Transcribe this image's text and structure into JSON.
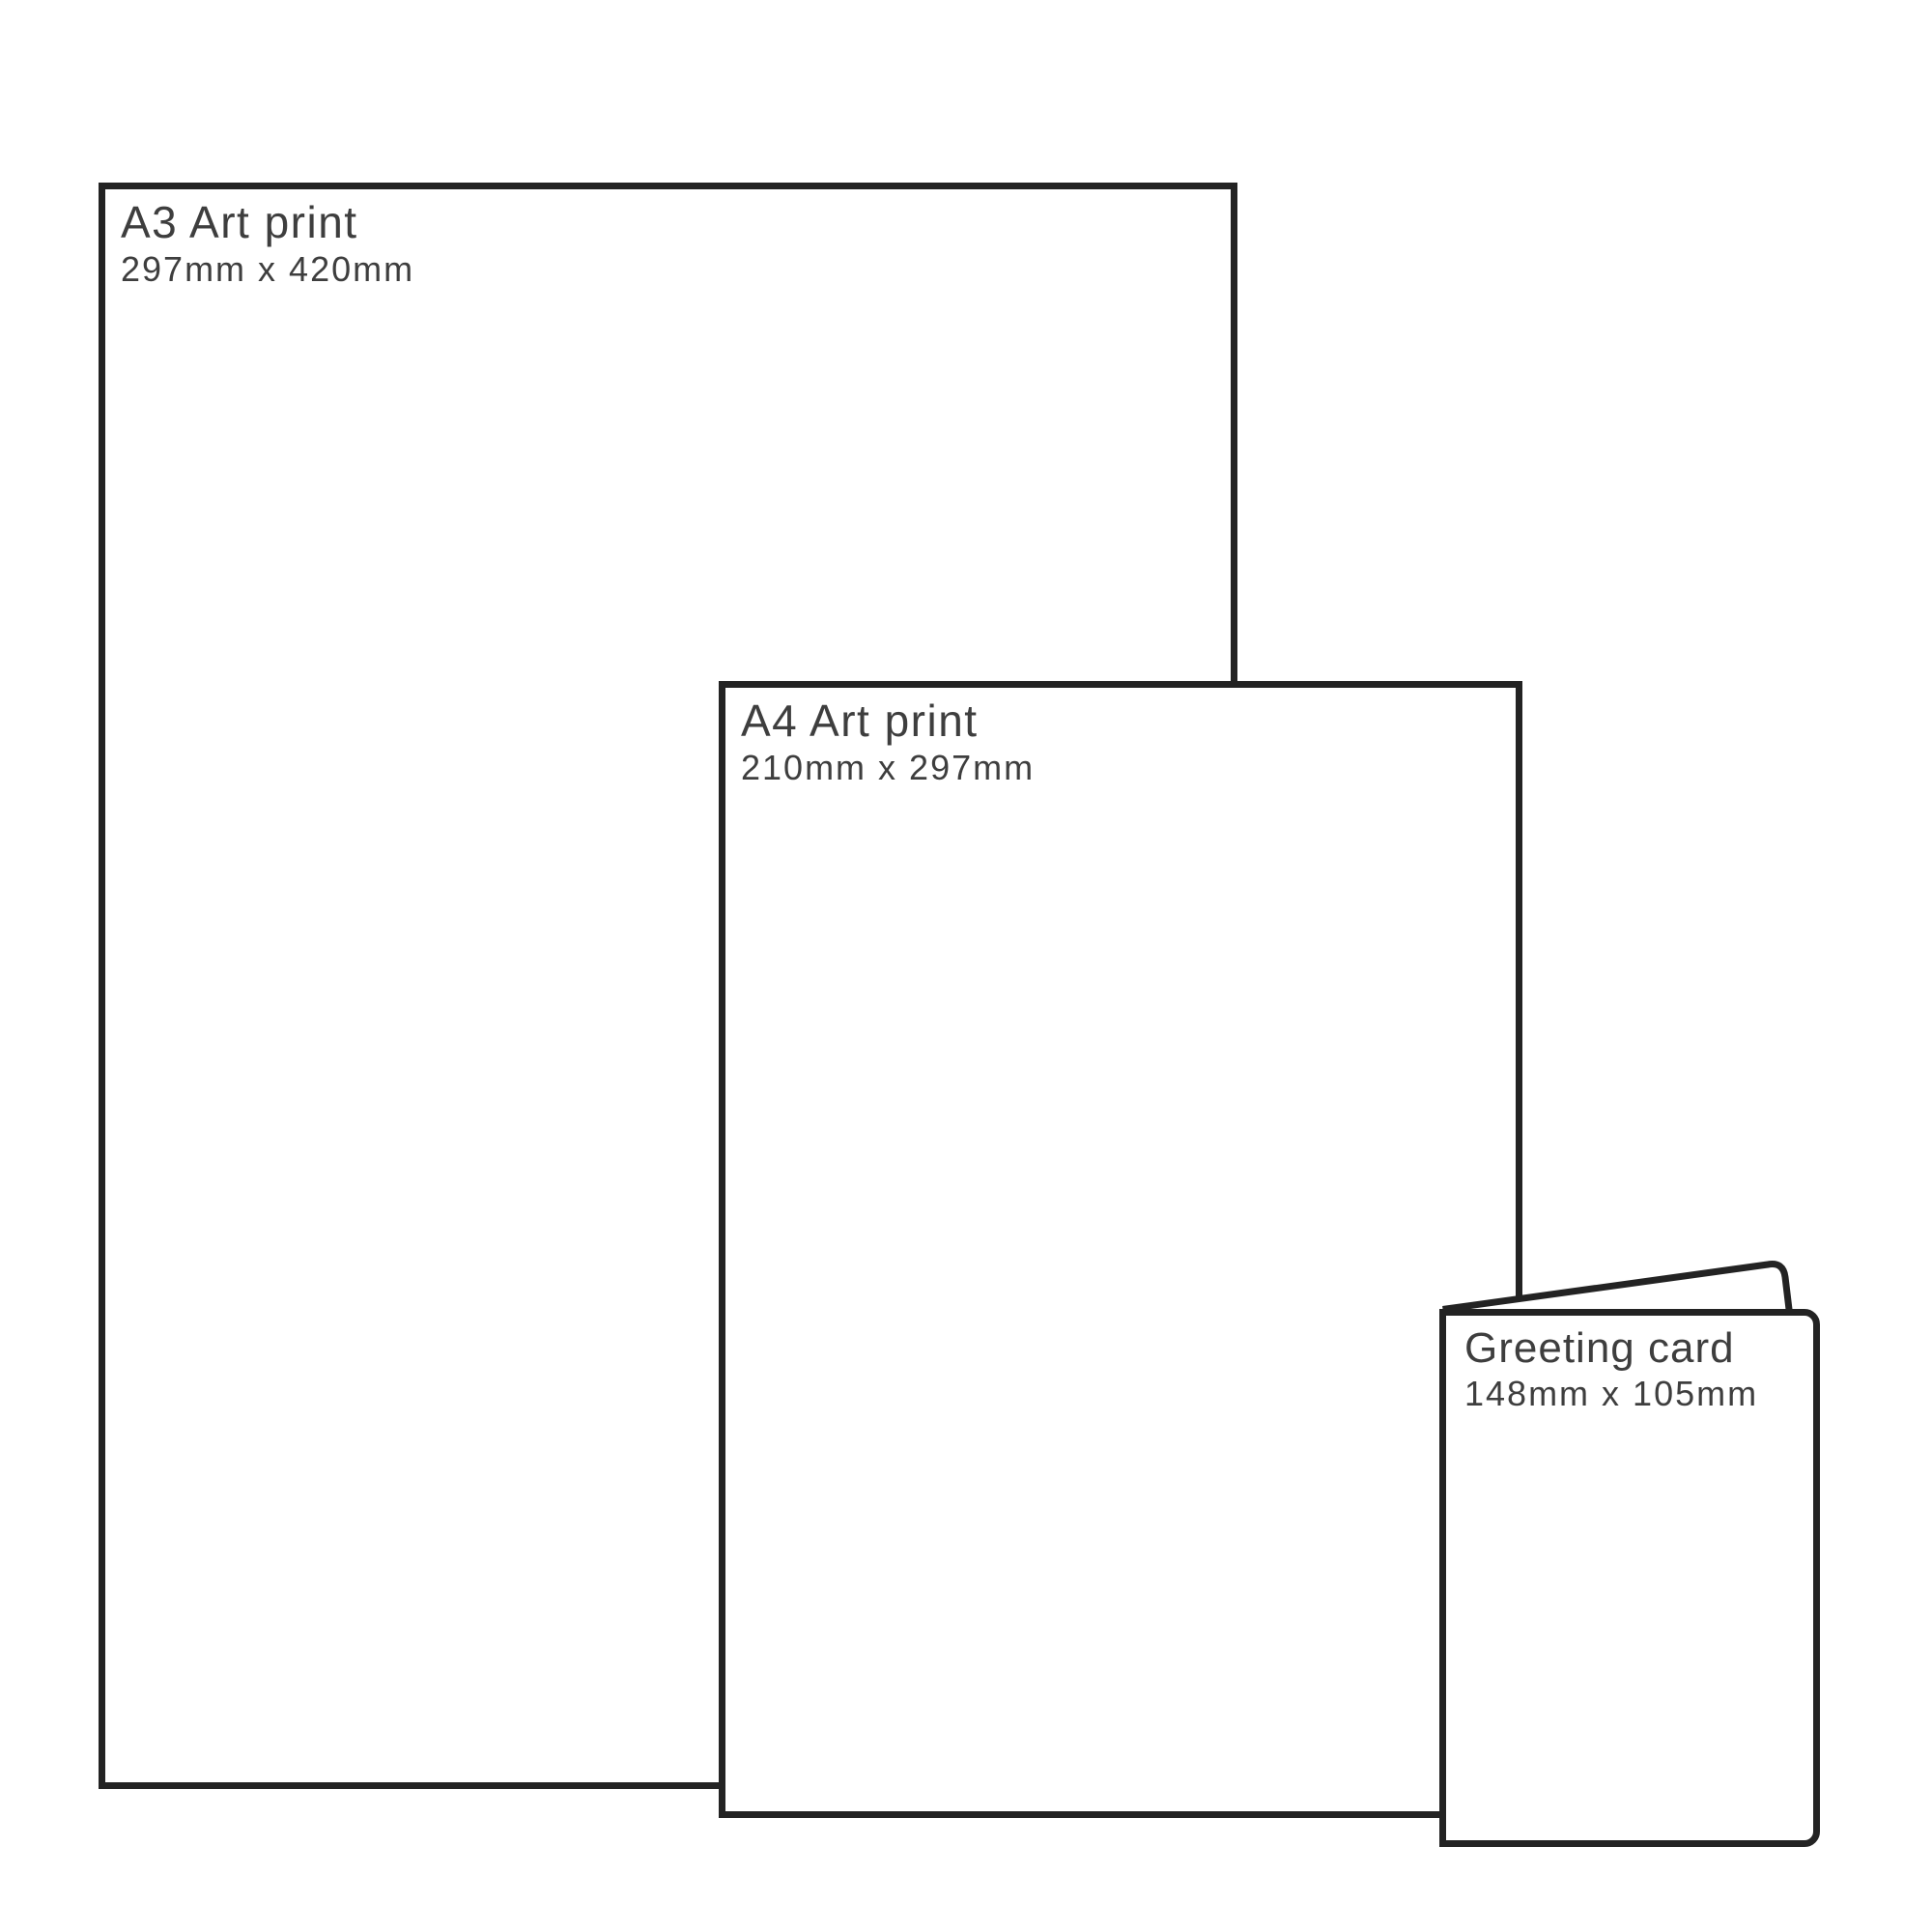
{
  "diagram": {
    "description": "Print size comparison diagram",
    "background_color": "#ffffff",
    "outline_color": "#232323",
    "text_color": "#3e3e3e"
  },
  "sheets": [
    {
      "id": "a3-art-print",
      "title": "A3 Art print",
      "dims": "297mm x 420mm"
    },
    {
      "id": "a4-art-print",
      "title": "A4 Art print",
      "dims": "210mm x 297mm"
    },
    {
      "id": "greeting-card",
      "title": "Greeting card",
      "dims": "148mm x 105mm"
    }
  ]
}
